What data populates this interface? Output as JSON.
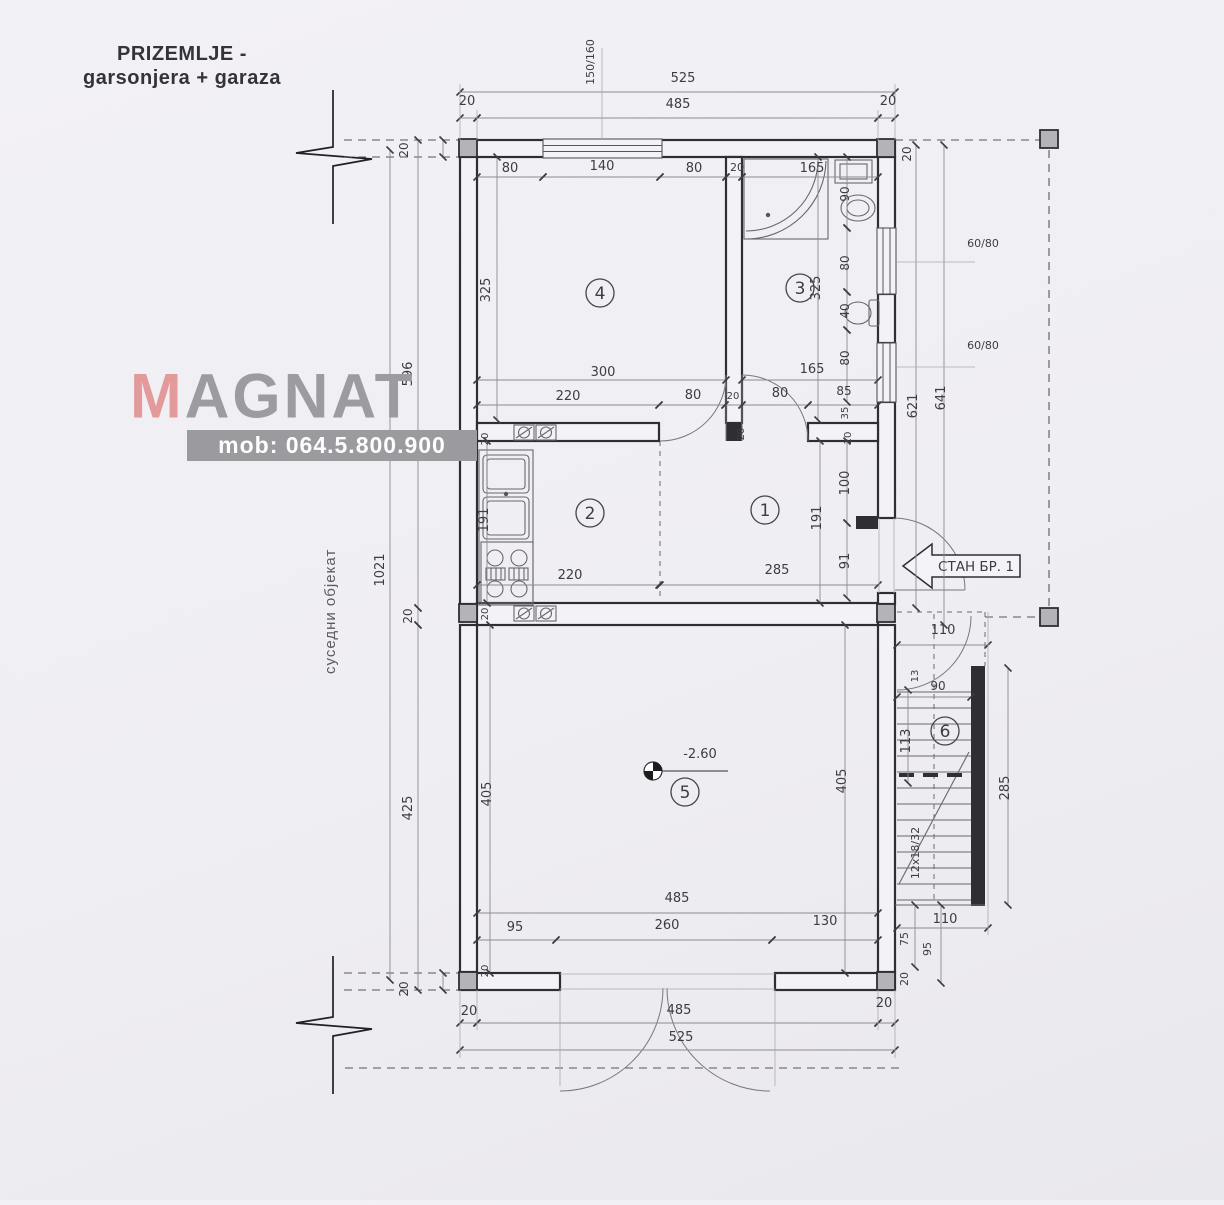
{
  "header": {
    "title_line1": "PRIZEMLJE -",
    "title_line2": "garsonjera + garaza"
  },
  "watermark": {
    "brand_first_letter": "M",
    "brand_rest": "AGNAT",
    "phone": "mob: 064.5.800.900",
    "accent_color": "#e39a9a",
    "gray_color": "#9c9ca0"
  },
  "side_note": "суседни објекат",
  "plan": {
    "entrance_label": "СТАН БР. 1",
    "elevation_value": "-2.60",
    "stairs_spec": "12x18/32",
    "rooms": [
      {
        "number": "1",
        "x": 765,
        "y": 510
      },
      {
        "number": "2",
        "x": 590,
        "y": 513
      },
      {
        "number": "3",
        "x": 800,
        "y": 288
      },
      {
        "number": "4",
        "x": 600,
        "y": 293
      },
      {
        "number": "5",
        "x": 685,
        "y": 792
      },
      {
        "number": "6",
        "x": 945,
        "y": 731
      }
    ],
    "labels": [
      {
        "text": "150/160",
        "x": 594,
        "y": 62,
        "rot": -90,
        "fs": 11
      },
      {
        "text": "525",
        "x": 683,
        "y": 82
      },
      {
        "text": "485",
        "x": 678,
        "y": 108
      },
      {
        "text": "20",
        "x": 467,
        "y": 105
      },
      {
        "text": "20",
        "x": 888,
        "y": 105
      },
      {
        "text": "20",
        "x": 911,
        "y": 154,
        "rot": -90,
        "fs": 12
      },
      {
        "text": "20",
        "x": 408,
        "y": 150,
        "rot": -90,
        "fs": 12
      },
      {
        "text": "80",
        "x": 510,
        "y": 172
      },
      {
        "text": "140",
        "x": 602,
        "y": 170
      },
      {
        "text": "80",
        "x": 694,
        "y": 172
      },
      {
        "text": "20",
        "x": 737,
        "y": 171,
        "fs": 11
      },
      {
        "text": "165",
        "x": 812,
        "y": 172
      },
      {
        "text": "90",
        "x": 849,
        "y": 194,
        "rot": -90,
        "fs": 12
      },
      {
        "text": "325",
        "x": 490,
        "y": 290,
        "rot": -90
      },
      {
        "text": "325",
        "x": 820,
        "y": 288,
        "rot": -90
      },
      {
        "text": "80",
        "x": 849,
        "y": 263,
        "rot": -90,
        "fs": 12
      },
      {
        "text": "40",
        "x": 849,
        "y": 311,
        "rot": -90,
        "fs": 12
      },
      {
        "text": "80",
        "x": 849,
        "y": 358,
        "rot": -90,
        "fs": 12
      },
      {
        "text": "60/80",
        "x": 983,
        "y": 247,
        "fs": 11
      },
      {
        "text": "60/80",
        "x": 983,
        "y": 349,
        "fs": 11
      },
      {
        "text": "621",
        "x": 917,
        "y": 406,
        "rot": -90
      },
      {
        "text": "641",
        "x": 945,
        "y": 398,
        "rot": -90
      },
      {
        "text": "300",
        "x": 603,
        "y": 376
      },
      {
        "text": "165",
        "x": 812,
        "y": 373
      },
      {
        "text": "220",
        "x": 568,
        "y": 400
      },
      {
        "text": "80",
        "x": 693,
        "y": 399
      },
      {
        "text": "20",
        "x": 733,
        "y": 399,
        "fs": 10
      },
      {
        "text": "80",
        "x": 780,
        "y": 397
      },
      {
        "text": "85",
        "x": 844,
        "y": 395,
        "fs": 12
      },
      {
        "text": "35",
        "x": 848,
        "y": 413,
        "rot": -90,
        "fs": 10
      },
      {
        "text": "20",
        "x": 851,
        "y": 438,
        "rot": -90,
        "fs": 10
      },
      {
        "text": "596",
        "x": 412,
        "y": 374,
        "rot": -90
      },
      {
        "text": "20",
        "x": 488,
        "y": 439,
        "rot": -90,
        "fs": 10
      },
      {
        "text": "191",
        "x": 488,
        "y": 520,
        "rot": -90
      },
      {
        "text": "220",
        "x": 570,
        "y": 579
      },
      {
        "text": "285",
        "x": 777,
        "y": 574
      },
      {
        "text": "191",
        "x": 821,
        "y": 518,
        "rot": -90
      },
      {
        "text": "100",
        "x": 849,
        "y": 483,
        "rot": -90
      },
      {
        "text": "91",
        "x": 849,
        "y": 561,
        "rot": -90
      },
      {
        "text": "20",
        "x": 744,
        "y": 434,
        "rot": -90,
        "fs": 10
      },
      {
        "text": "1021",
        "x": 384,
        "y": 570,
        "rot": -90
      },
      {
        "text": "20",
        "x": 412,
        "y": 616,
        "rot": -90,
        "fs": 12
      },
      {
        "text": "20",
        "x": 488,
        "y": 614,
        "rot": -90,
        "fs": 10
      },
      {
        "text": "-2.60",
        "x": 700,
        "y": 758
      },
      {
        "text": "405",
        "x": 491,
        "y": 794,
        "rot": -90
      },
      {
        "text": "405",
        "x": 846,
        "y": 781,
        "rot": -90
      },
      {
        "text": "425",
        "x": 412,
        "y": 808,
        "rot": -90
      },
      {
        "text": "110",
        "x": 943,
        "y": 634
      },
      {
        "text": "13",
        "x": 918,
        "y": 676,
        "rot": -90,
        "fs": 10
      },
      {
        "text": "90",
        "x": 938,
        "y": 690,
        "fs": 12
      },
      {
        "text": "113",
        "x": 910,
        "y": 741,
        "rot": -90
      },
      {
        "text": "285",
        "x": 1009,
        "y": 788,
        "rot": -90
      },
      {
        "text": "12x18/32",
        "x": 919,
        "y": 853,
        "rot": -90,
        "fs": 11
      },
      {
        "text": "485",
        "x": 677,
        "y": 902
      },
      {
        "text": "95",
        "x": 515,
        "y": 931
      },
      {
        "text": "260",
        "x": 667,
        "y": 929
      },
      {
        "text": "130",
        "x": 825,
        "y": 925
      },
      {
        "text": "20",
        "x": 488,
        "y": 971,
        "rot": -90,
        "fs": 10
      },
      {
        "text": "110",
        "x": 945,
        "y": 923
      },
      {
        "text": "75",
        "x": 908,
        "y": 939,
        "rot": -90,
        "fs": 11
      },
      {
        "text": "95",
        "x": 931,
        "y": 949,
        "rot": -90,
        "fs": 11
      },
      {
        "text": "20",
        "x": 908,
        "y": 979,
        "rot": -90,
        "fs": 11
      },
      {
        "text": "20",
        "x": 469,
        "y": 1015
      },
      {
        "text": "20",
        "x": 884,
        "y": 1007
      },
      {
        "text": "485",
        "x": 679,
        "y": 1014
      },
      {
        "text": "525",
        "x": 681,
        "y": 1041
      },
      {
        "text": "20",
        "x": 408,
        "y": 989,
        "rot": -90,
        "fs": 12
      }
    ]
  }
}
